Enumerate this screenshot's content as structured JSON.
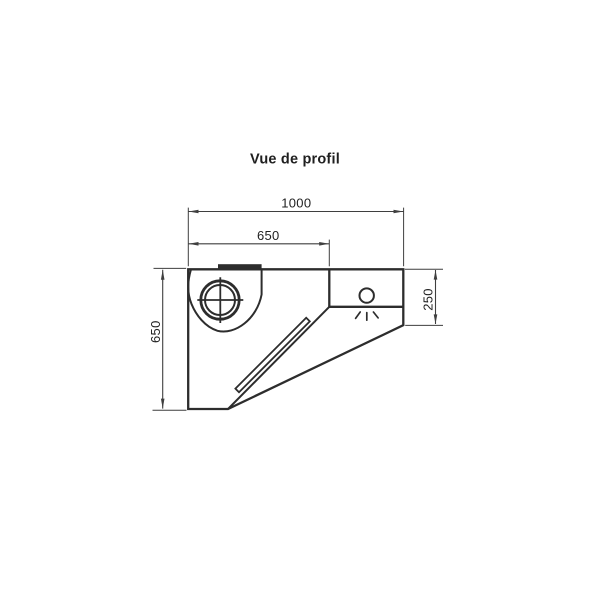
{
  "title": "Vue de profil",
  "drawing": {
    "type": "technical-profile-drawing-wall-hood",
    "colors": {
      "background": "#ffffff",
      "outline": "#2d2d2d",
      "dimension_lines": "#3f3f3f",
      "text": "#1f1f1f"
    },
    "dimensions": [
      {
        "id": "overall-width-top",
        "value": "1000",
        "orientation": "horizontal"
      },
      {
        "id": "motor-section-width",
        "value": "650",
        "orientation": "horizontal"
      },
      {
        "id": "overall-height-left",
        "value": "650",
        "orientation": "vertical"
      },
      {
        "id": "front-section-height",
        "value": "250",
        "orientation": "vertical"
      }
    ],
    "symbols": [
      "fan-motor-icon",
      "fan-volute",
      "exhaust-outlet",
      "grease-filter-strip",
      "lamp-icon"
    ]
  }
}
